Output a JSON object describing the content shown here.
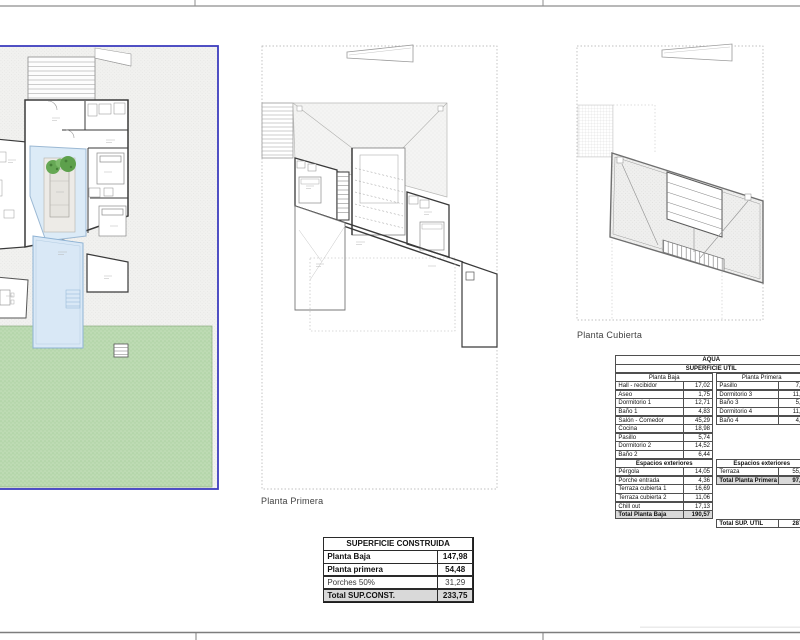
{
  "sheet": {
    "type": "architectural drawing sheet (villa floor plans crop)"
  },
  "plans": {
    "primera": {
      "label": "Planta Primera"
    },
    "cubierta": {
      "label": "Planta Cubierta"
    }
  },
  "colors": {
    "plot_border": "#3d3dbe",
    "garden": "#bedbb4",
    "pool": "#d9e8f6",
    "pool_edge": "#8fb3d4",
    "wall": "#3a3a3a",
    "table_total_bg": "#d9d9d9"
  },
  "tables": {
    "util": {
      "title": "AQUA",
      "subtitle": "SUPERFICIE UTIL",
      "columns": {
        "left": "Planta Baja",
        "right": "Planta Primera"
      },
      "left": {
        "rows": [
          [
            "Hall - recibidor",
            "17,02"
          ],
          [
            "Aseo",
            "1,75"
          ],
          [
            "Dormitorio 1",
            "12,71"
          ],
          [
            "Baño 1",
            "4,83"
          ],
          [
            "Salón - Comedor",
            "45,29"
          ],
          [
            "Cocina",
            "18,98"
          ],
          [
            "Pasillo",
            "5,74"
          ],
          [
            "Dormitorio 2",
            "14,52"
          ],
          [
            "Baño 2",
            "6,44"
          ]
        ],
        "exterior_header": "Espacios exteriores",
        "exterior_rows": [
          [
            "Pérgola",
            "14,05"
          ],
          [
            "Porche entrada",
            "4,36"
          ],
          [
            "Terraza cubierta 1",
            "16,69"
          ],
          [
            "Terraza cubierta 2",
            "11,06"
          ],
          [
            "Chill out",
            "17,13"
          ]
        ],
        "total": [
          "Total Planta Baja",
          "190,57"
        ]
      },
      "right": {
        "rows": [
          [
            "Pasillo",
            "7,2"
          ],
          [
            "Dormitorio 3",
            "11,5"
          ],
          [
            "Baño 3",
            "5,5"
          ],
          [
            "Dormitorio 4",
            "11,9"
          ],
          [
            "Baño 4",
            "4,9"
          ]
        ],
        "exterior_header": "Espacios exteriores",
        "exterior_rows": [
          [
            "Terraza",
            "55,1"
          ]
        ],
        "total": [
          "Total Planta Primera",
          "97,0"
        ],
        "grand_total": [
          "Total SUP. UTIL",
          "287,"
        ]
      }
    },
    "construida": {
      "title": "SUPERFICIE CONSTRUIDA",
      "rows": [
        {
          "label": "Planta Baja",
          "value": "147,98",
          "bold": true,
          "total": false
        },
        {
          "label": "Planta primera",
          "value": "54,48",
          "bold": true,
          "total": false
        },
        {
          "label": "Porches 50%",
          "value": "31,29",
          "bold": false,
          "total": false
        },
        {
          "label": "Total SUP.CONST.",
          "value": "233,75",
          "bold": true,
          "total": true
        }
      ]
    }
  }
}
